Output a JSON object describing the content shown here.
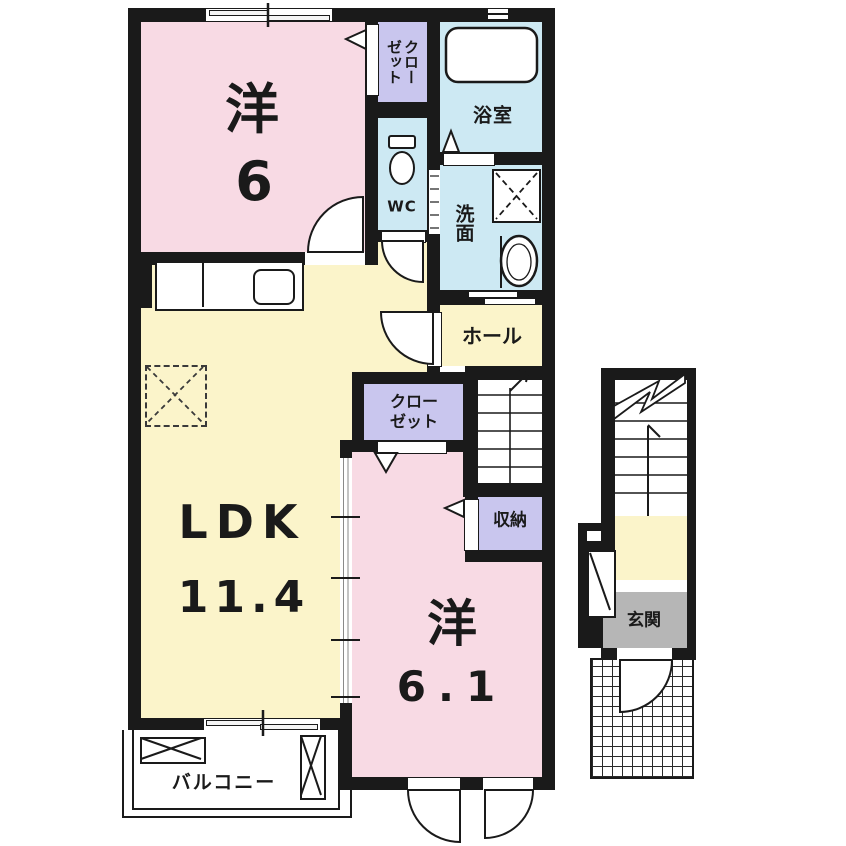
{
  "title": "2LDK apartment floor plan",
  "rooms": {
    "bedroom1": {
      "label": "洋",
      "size": "6"
    },
    "closet_top": {
      "col1": "クロー",
      "col2": "ゼット"
    },
    "bathroom": {
      "label": "浴室"
    },
    "toilet": {
      "label": "WC"
    },
    "washroom": {
      "label": "洗面"
    },
    "hall": {
      "label": "ホール"
    },
    "ldk": {
      "label": "LDK",
      "size": "11.4"
    },
    "closet_mid": {
      "line1": "クロー",
      "line2": "ゼット"
    },
    "storage": {
      "label": "収納"
    },
    "bedroom2": {
      "label": "洋",
      "size": "6.1"
    },
    "balcony": {
      "label": "バルコニー"
    },
    "entrance": {
      "label": "玄関"
    }
  },
  "colors": {
    "wall": "#1a1a1a",
    "room-pink": "#f8dae4",
    "room-yellow": "#fbf4ca",
    "room-blue": "#cde9f3",
    "room-purple": "#c9c6ee",
    "entrance-gray": "#b6b6b6"
  }
}
